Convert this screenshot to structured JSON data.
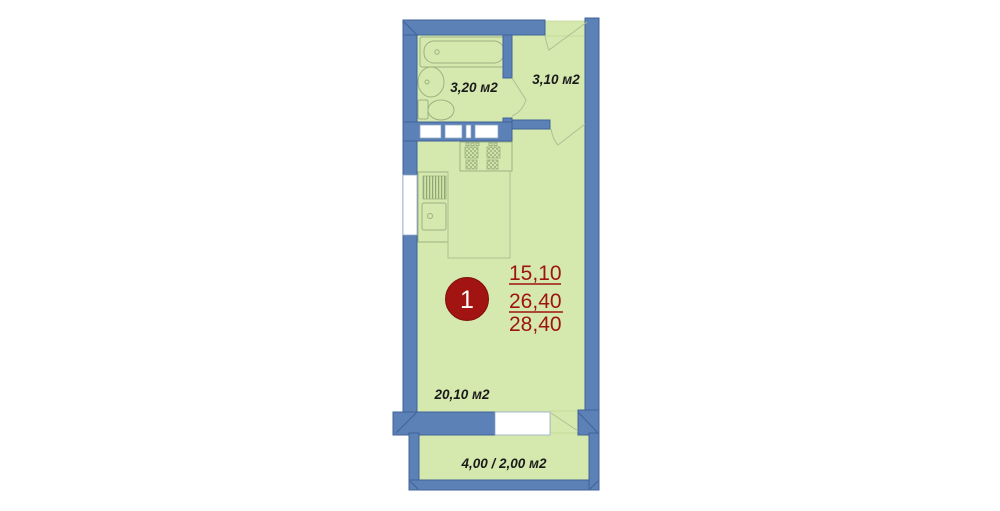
{
  "title": "apartment-floor-plan",
  "unit": {
    "number": "1"
  },
  "area_table": {
    "living_area": "15,10",
    "apartment_area": "26,40",
    "total_area": "28,40"
  },
  "rooms": {
    "bathroom": {
      "label": "3,20 м2"
    },
    "hallway": {
      "label": "3,10 м2"
    },
    "living_room": {
      "label": "20,10 м2"
    },
    "balcony": {
      "label": "4,00 / 2,00 м2"
    }
  },
  "icons": {
    "bathtub": "bathtub-icon",
    "washbasin": "washbasin-icon",
    "toilet": "toilet-icon",
    "stove": "stove-icon",
    "kitchen_sink": "kitchen-sink-icon",
    "door_swing": "door-swing-icon",
    "window": "window-icon"
  },
  "colors": {
    "wall": "#5b81b6",
    "wall_outline": "#41639a",
    "room_fill": "#d5e9ae",
    "fixture_line": "#9cb183",
    "accent_red": "#9d140f",
    "badge_fill": "#a21411",
    "badge_text": "#ffffff",
    "label_text": "#1a1a1a",
    "background": "#ffffff"
  }
}
